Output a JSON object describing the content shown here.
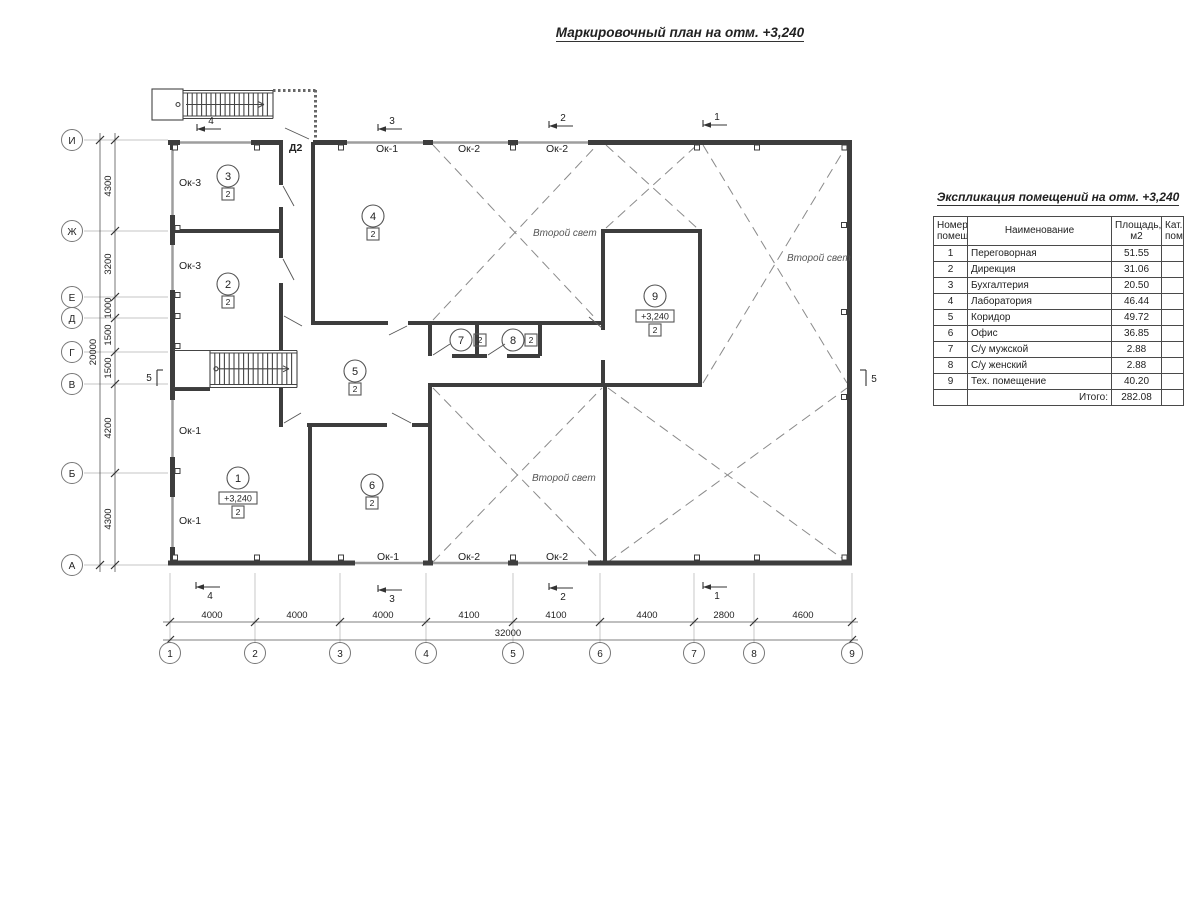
{
  "title": "Маркировочный план на отм. +3,240",
  "table": {
    "title": "Экспликация помещений на отм. +3,240",
    "headers": {
      "num": "Номер\nпомещ.",
      "name": "Наименование",
      "area": "Площадь,\nм2",
      "cat": "Кат.\nпом."
    },
    "rows": [
      {
        "num": "1",
        "name": "Переговорная",
        "area": "51.55",
        "cat": ""
      },
      {
        "num": "2",
        "name": "Дирекция",
        "area": "31.06",
        "cat": ""
      },
      {
        "num": "3",
        "name": "Бухгалтерия",
        "area": "20.50",
        "cat": ""
      },
      {
        "num": "4",
        "name": "Лаборатория",
        "area": "46.44",
        "cat": ""
      },
      {
        "num": "5",
        "name": "Коридор",
        "area": "49.72",
        "cat": ""
      },
      {
        "num": "6",
        "name": "Офис",
        "area": "36.85",
        "cat": ""
      },
      {
        "num": "7",
        "name": "С/у мужской",
        "area": "2.88",
        "cat": ""
      },
      {
        "num": "8",
        "name": "С/у женский",
        "area": "2.88",
        "cat": ""
      },
      {
        "num": "9",
        "name": "Тех. помещение",
        "area": "40.20",
        "cat": ""
      }
    ],
    "total_label": "Итого:",
    "total_value": "282.08"
  },
  "plan": {
    "elevation_mark": "+3,240",
    "second_light": "Второй свет",
    "door_label": "Д2",
    "windows": {
      "ok1": "Ок-1",
      "ok2": "Ок-2",
      "ok3": "Ок-3"
    },
    "floor_badge": "2",
    "rooms": [
      "1",
      "2",
      "3",
      "4",
      "5",
      "6",
      "7",
      "8",
      "9"
    ],
    "axes": {
      "rows": [
        "И",
        "Ж",
        "Е",
        "Д",
        "Г",
        "В",
        "Б",
        "А"
      ],
      "cols": [
        "1",
        "2",
        "3",
        "4",
        "5",
        "6",
        "7",
        "8",
        "9"
      ]
    },
    "dims": {
      "left": [
        "4300",
        "3200",
        "1000",
        "1500",
        "1500",
        "4200",
        "4300"
      ],
      "left_total": "20000",
      "bottom": [
        "4000",
        "4000",
        "4000",
        "4100",
        "4100",
        "4400",
        "2800",
        "4600"
      ],
      "bottom_total": "32000"
    },
    "sections": {
      "s1": "1",
      "s2": "2",
      "s3": "3",
      "s4": "4",
      "s5": "5"
    }
  }
}
